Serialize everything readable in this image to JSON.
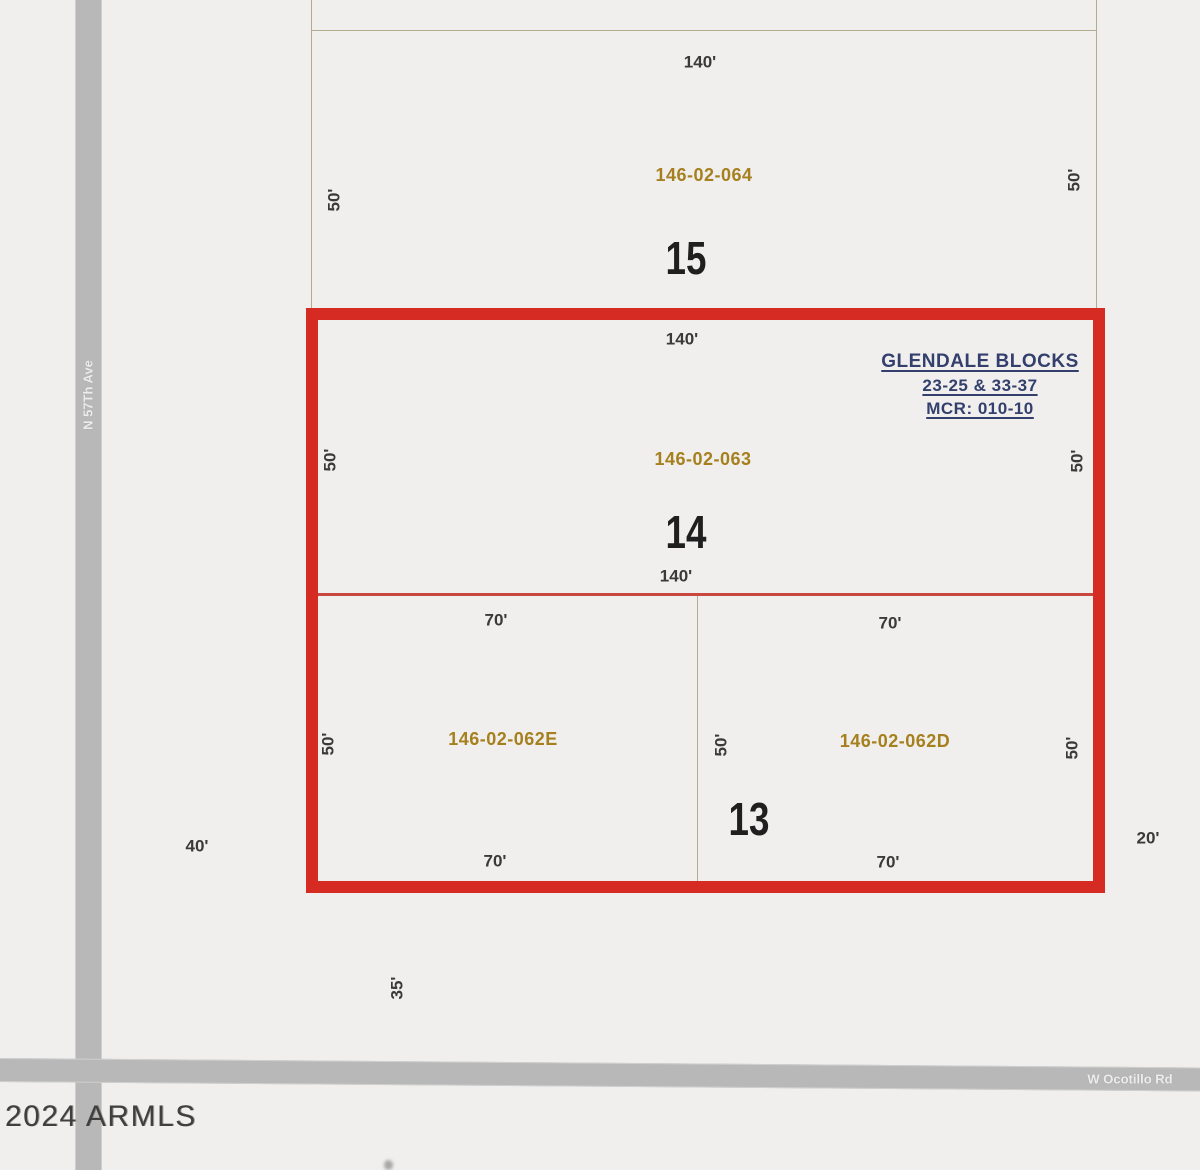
{
  "watermark": "2024 ARMLS",
  "roads": {
    "vertical_label": "N 57Th Ave",
    "horizontal_label": "W Ocotillo Rd"
  },
  "plat_note": {
    "line1": "GLENDALE BLOCKS",
    "line2": "23-25 & 33-37",
    "line3": "MCR: 010-10"
  },
  "blocks": {
    "b15": {
      "number": "15",
      "apn": "146-02-064",
      "dim_top": "140'",
      "dim_left": "50'",
      "dim_right": "50'"
    },
    "b14": {
      "number": "14",
      "apn": "146-02-063",
      "dim_top": "140'",
      "dim_bottom": "140'",
      "dim_left": "50'",
      "dim_right": "50'"
    },
    "b13": {
      "number": "13",
      "lot_e": {
        "apn": "146-02-062E",
        "dim_top": "70'",
        "dim_bottom": "70'",
        "dim_left": "50'"
      },
      "lot_d": {
        "apn": "146-02-062D",
        "dim_top": "70'",
        "dim_bottom": "70'",
        "dim_left": "50'",
        "dim_right": "50'"
      }
    }
  },
  "outer_dims": {
    "west": "40'",
    "east": "20'",
    "south": "35'"
  },
  "colors": {
    "highlight_red": "#d62b23",
    "apn_gold": "#a6801f",
    "note_navy": "#333f6d",
    "road_gray": "#b8b8b8",
    "boundary_tan": "#b3ab8f",
    "background": "#f0efed"
  }
}
